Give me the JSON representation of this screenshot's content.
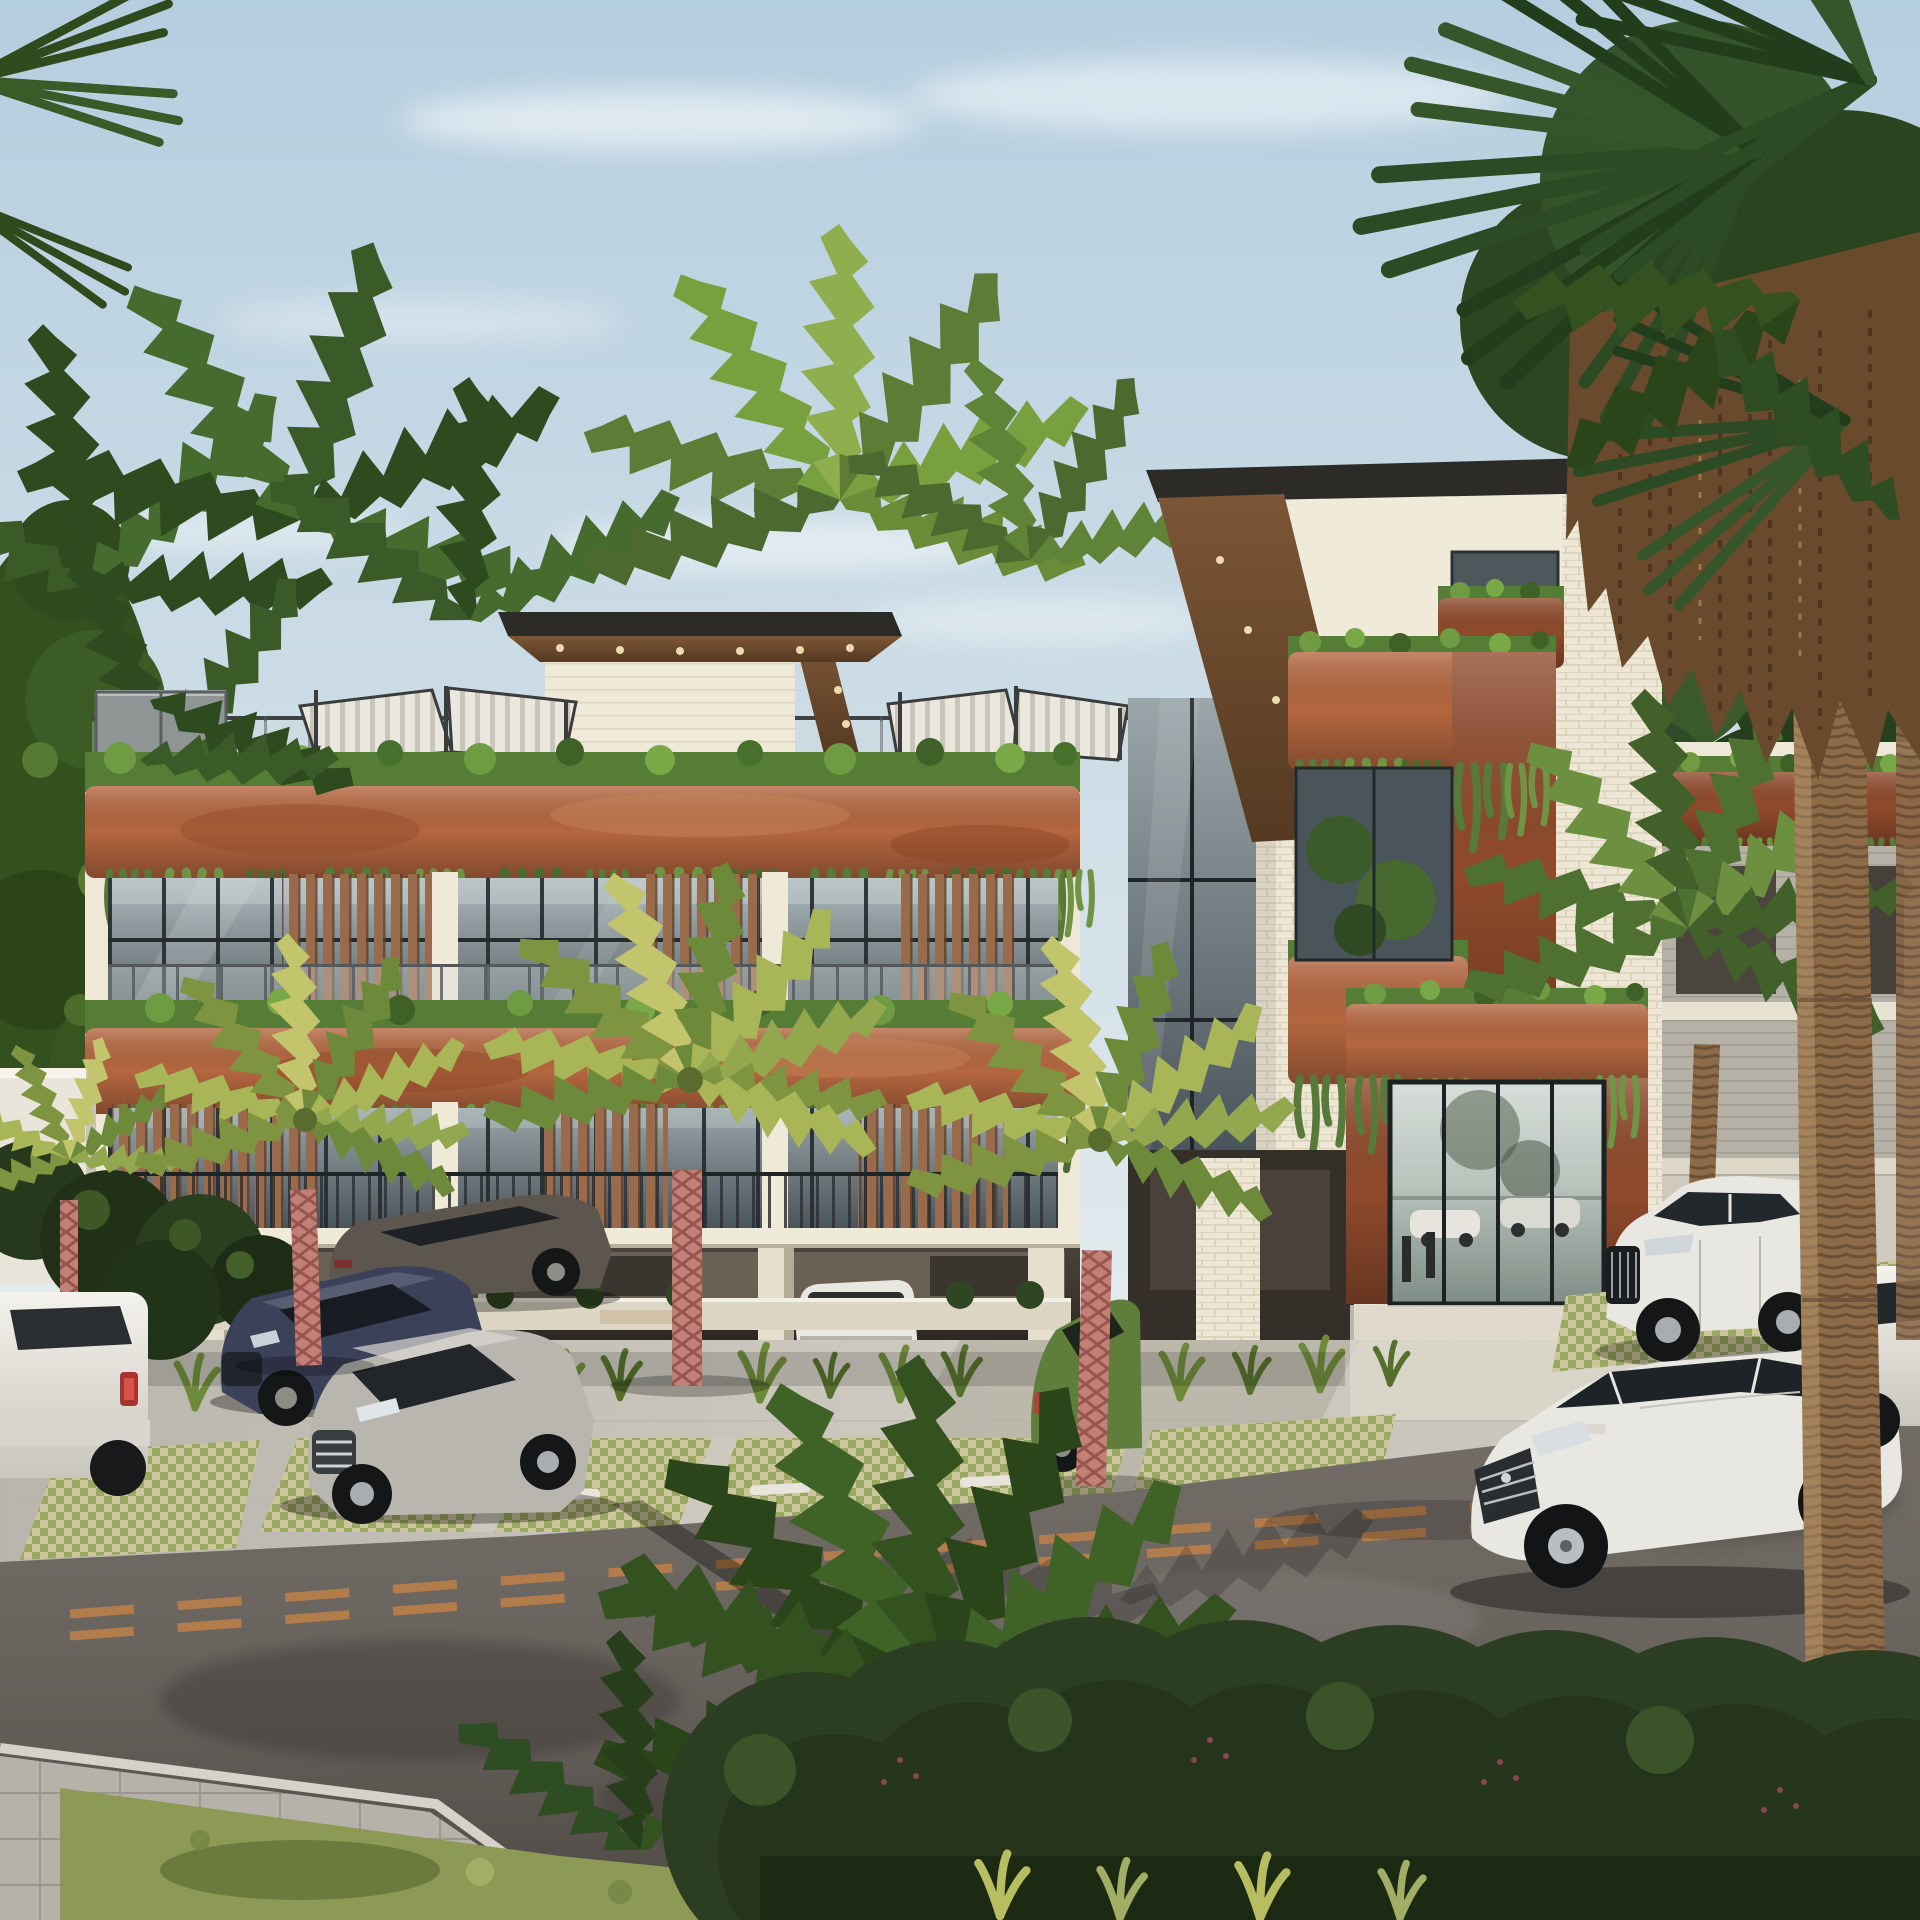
{
  "scene": {
    "kind": "architectural exterior rendering",
    "subject": "modern 3-level eco condo building with copper planter bands, hanging vines, wood louvers, white-brick entry tower, rooftop pergolas, palm-lined parking lot and street",
    "colors": {
      "sky": "#b5cedf",
      "skyLow": "#e7edee",
      "cloud": "#ffffff",
      "foliageDark": "#2a4519",
      "foliageMid": "#4e7030",
      "foliageBright": "#79a03f",
      "palmYellow": "#a9b657",
      "terracotta": "#b4663f",
      "terracottaDeep": "#8f4a2c",
      "planterGreen": "#567d36",
      "vineGreen": "#5b8038",
      "creamWall": "#efe8d6",
      "brick": "#eee7d5",
      "roofDark": "#2c2b28",
      "woodSoffit": "#6e4b31",
      "woodSlat": "#9a6b4b",
      "glassDark": "#49555b",
      "glassSky": "#c3ced2",
      "pergola": "#eae7df",
      "railing": "#3f4142",
      "pavement": "#d2cec4",
      "paverTan": "#ccc69c",
      "grassPaver": "#9aa962",
      "road": "#655e58",
      "roadLine": "#c08148",
      "sidewalk": "#b6b2aa",
      "verge": "#8d9a55",
      "hedge": "#2c3e22",
      "berry": "#8a4650",
      "trunkBrown": "#8d6b49",
      "trunkPink": "#c28077",
      "thatch": "#6a4a2c",
      "carWhite": "#e9e7e1",
      "carSilver": "#b9b6b0",
      "carBlue": "#3b4158",
      "carGray": "#5d564e",
      "carGreen": "#5f7d3b",
      "shadow": "#1d1a16"
    },
    "objects": {
      "building": {
        "levels": "2 residential floors over open parking",
        "features": [
          "copper planter bands with hanging vines",
          "vertical wood louvers over glazing",
          "rooftop pergola canopies",
          "white brick entry tower with copper portal",
          "right wing with planter parapet"
        ]
      },
      "vehicles": [
        {
          "type": "sedan (rear view)",
          "color": "white",
          "location": "far left"
        },
        {
          "type": "sports sedan",
          "color": "dark gray",
          "location": "under canopy"
        },
        {
          "type": "sedan",
          "color": "dark blue",
          "location": "front parking"
        },
        {
          "type": "sedan",
          "color": "silver",
          "location": "front parking"
        },
        {
          "type": "SUV",
          "color": "white",
          "location": "under canopy"
        },
        {
          "type": "hatchback",
          "color": "green",
          "location": "near entrance"
        },
        {
          "type": "SUV",
          "color": "white",
          "location": "right of entrance"
        },
        {
          "type": "sedan",
          "color": "white",
          "location": "driving on street"
        },
        {
          "type": "car (partial)",
          "color": "white",
          "location": "far right edge"
        }
      ],
      "palms": [
        "background cluster left",
        "two crowns behind roofline",
        "three pink-trunk palms in parking strip",
        "small palm by left wall",
        "feather palm at right wing",
        "tall fan palm far right with dry thatch",
        "young palm on bottom-left verge"
      ],
      "street": {
        "markings": "double dashed amber center line",
        "landscaping": "row of round clipped bushes"
      }
    }
  }
}
